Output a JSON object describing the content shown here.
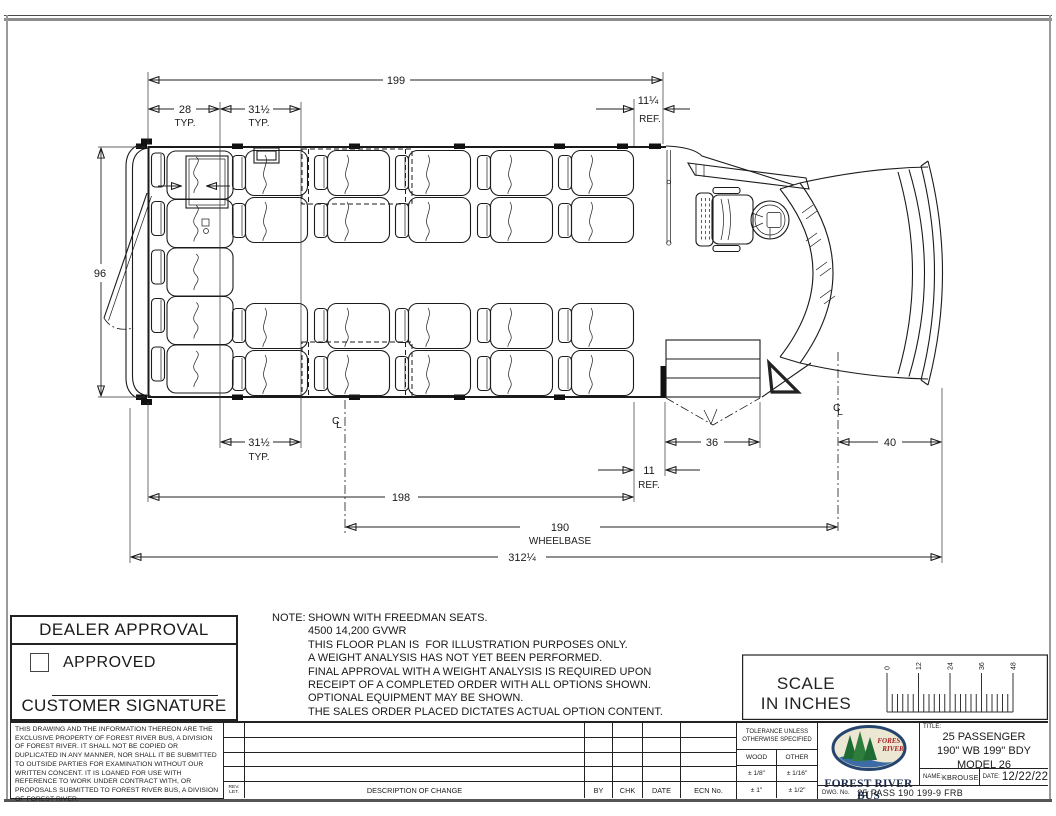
{
  "drawing": {
    "dims": {
      "body_length": "199",
      "rear_spacing": "28",
      "typ": "TYP.",
      "seat_pitch": "31½",
      "front_ref": "11¼",
      "ref": "REF.",
      "body_width": "96",
      "door_width": "36",
      "front_overhang": "40",
      "door_ref": "11",
      "floor_length": "198",
      "wheelbase": "190",
      "wheelbase_label": "WHEELBASE",
      "overall_length": "312¼",
      "centerline_c": "C",
      "centerline_l": "L"
    }
  },
  "dealer": {
    "title": "DEALER APPROVAL",
    "approved": "APPROVED",
    "signature": "CUSTOMER SIGNATURE"
  },
  "notes": {
    "label": "NOTE:",
    "lines": [
      "SHOWN WITH FREEDMAN SEATS.",
      "4500 14,200 GVWR",
      "THIS FLOOR PLAN IS  FOR ILLUSTRATION PURPOSES ONLY.",
      "A WEIGHT ANALYSIS HAS NOT YET BEEN PERFORMED.",
      "FINAL APPROVAL WITH A WEIGHT ANALYSIS IS REQUIRED UPON",
      "RECEIPT OF A COMPLETED ORDER WITH ALL OPTIONS SHOWN.",
      "OPTIONAL EQUIPMENT MAY BE SHOWN.",
      "THE SALES ORDER PLACED DICTATES ACTUAL OPTION CONTENT."
    ]
  },
  "scale": {
    "title_line1": "SCALE",
    "title_line2": "IN INCHES",
    "ticks": [
      "0",
      "12",
      "24",
      "36",
      "48"
    ]
  },
  "legal": {
    "text": "THIS DRAWING AND THE INFORMATION THEREON ARE THE EXCLUSIVE PROPERTY OF FOREST RIVER BUS, A DIVISION OF FOREST RIVER. IT SHALL NOT BE COPIED OR DUPLICATED IN ANY MANNER, NOR SHALL IT BE SUBMITTED TO OUTSIDE PARTIES FOR EXAMINATION WITHOUT OUR WRITTEN CONCENT. IT IS LOANED FOR USE WITH REFERENCE TO WORK UNDER CONTRACT WITH, OR PROPOSALS SUBMITTED TO FOREST RIVER BUS, A DIVISION OF FOREST RIVER."
  },
  "revisions": {
    "rev_line1": "REV.",
    "rev_line2": "LET.",
    "description": "DESCRIPTION OF CHANGE",
    "by": "BY",
    "chk": "CHK",
    "date": "DATE",
    "ecn": "ECN No."
  },
  "tolerance": {
    "line1": "TOLERANCE UNLESS",
    "line2": "OTHERWISE SPECIFIED",
    "wood": "WOOD",
    "other": "OTHER",
    "wood_1": "± 1/8\"",
    "other_1": "± 1/16\"",
    "wood_2": "± 1\"",
    "other_2": "± 1/2\""
  },
  "logo": {
    "brand": "FOREST RIVER BUS",
    "oval_line1": "FOREST",
    "oval_line2": "RIVER",
    "colors": {
      "navy": "#26456e",
      "green": "#2e7d3a",
      "dark_green": "#1e6b34",
      "red": "#a62222",
      "water": "#3c6ba5",
      "cream": "#ece7d3"
    }
  },
  "title_block": {
    "title_label": "TITLE:",
    "line1": "25 PASSENGER",
    "line2": "190\" WB 199\" BDY",
    "line3": "MODEL 26",
    "name_label": "NAME:",
    "name_value": "KBROUSE",
    "date_label": "DATE:",
    "date_value": "12/22/22",
    "dwg_label": "DWG. No.",
    "dwg_value": "25 PASS 190 199-9 FRB"
  }
}
